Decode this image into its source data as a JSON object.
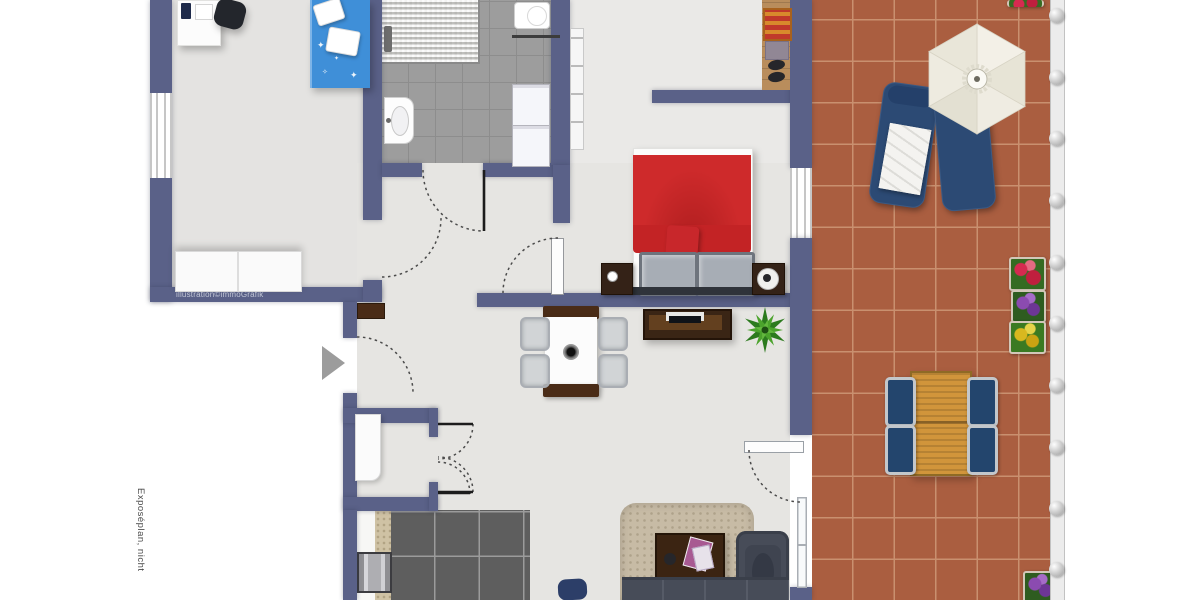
{
  "plan": {
    "watermark": "illustration©immoGrafik",
    "side_note": "Exposéplan, nicht",
    "icons": {
      "entrance_arrow": "triangle-right",
      "parasol": "hexagon-umbrella",
      "plant": "starburst-leaves"
    },
    "colors": {
      "wall": "#5a6188",
      "hall_floor": "#e6e5e2",
      "kids_floor": "#e4e3e1",
      "bedroom_floor": "#eae9e7",
      "bath_tile": "#9d9d9d",
      "kitchen_tile": "#5e5e5e",
      "terrace_tile": "#aa5e40",
      "terrace_grout": "#c9906f",
      "bed_red": "#ce2a2b",
      "bed_blue": "#3f8fd8",
      "furniture_navy": "#2c4a74",
      "wood_table": "#d1953b",
      "sofa_gray": "#474c58",
      "rug_beige": "#c7bba5",
      "dark_wood": "#3b2412"
    }
  }
}
